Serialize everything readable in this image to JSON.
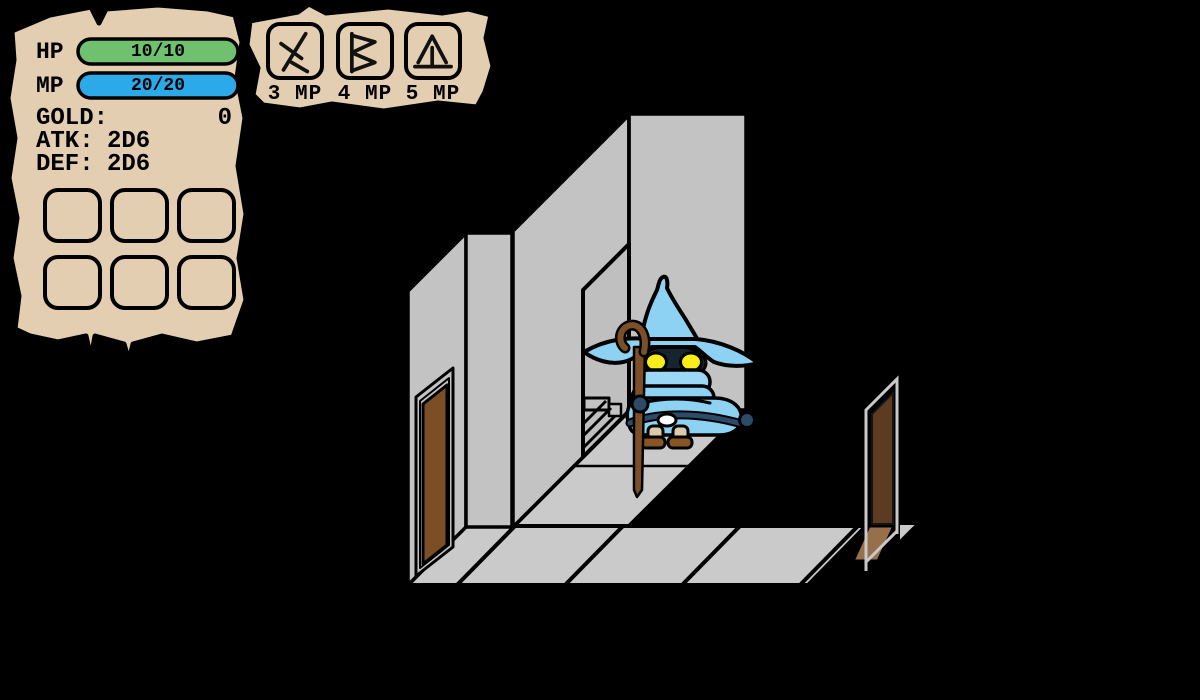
{
  "hud": {
    "hp": {
      "label": "HP",
      "value": "10/10",
      "bar_color": "#6FC06F"
    },
    "mp": {
      "label": "MP",
      "value": "20/20",
      "bar_color": "#2CA9E8"
    },
    "stats": [
      {
        "label": "GOLD:",
        "value": "0"
      },
      {
        "label": "ATK:",
        "value": "2D6"
      },
      {
        "label": "DEF:",
        "value": "2D6"
      }
    ],
    "inventory": {
      "slot_count": "6"
    }
  },
  "spellbar": {
    "spells": [
      {
        "icon": "rune-branch-icon",
        "cost": "3 MP"
      },
      {
        "icon": "rune-angular-b-icon",
        "cost": "4 MP"
      },
      {
        "icon": "rune-peak-icon",
        "cost": "5 MP"
      }
    ]
  },
  "scene": {
    "background_color": "#000000",
    "wall_color": "#C3C3C3",
    "doorway_color": "#BFBFBF",
    "floor_color": "#CACACA",
    "left_door_color": "#7B4E25",
    "right_door_color": "#5C3B20",
    "door_tile_color": "#97704B",
    "door_frame_color": "#C9C9C9",
    "wizard": {
      "hat_color": "#8DD2F3",
      "scarf_color": "#9AD8F6",
      "face_color": "#16242F",
      "eye_color": "#F8ED1B",
      "accent_color": "#2B4B69",
      "leg_color": "#D9CCAA",
      "boot_color": "#8A5526",
      "staff_color": "#7B4F28",
      "buckle_color": "#FFFFFF"
    }
  },
  "parchment": {
    "color": "#E4CEB1"
  }
}
